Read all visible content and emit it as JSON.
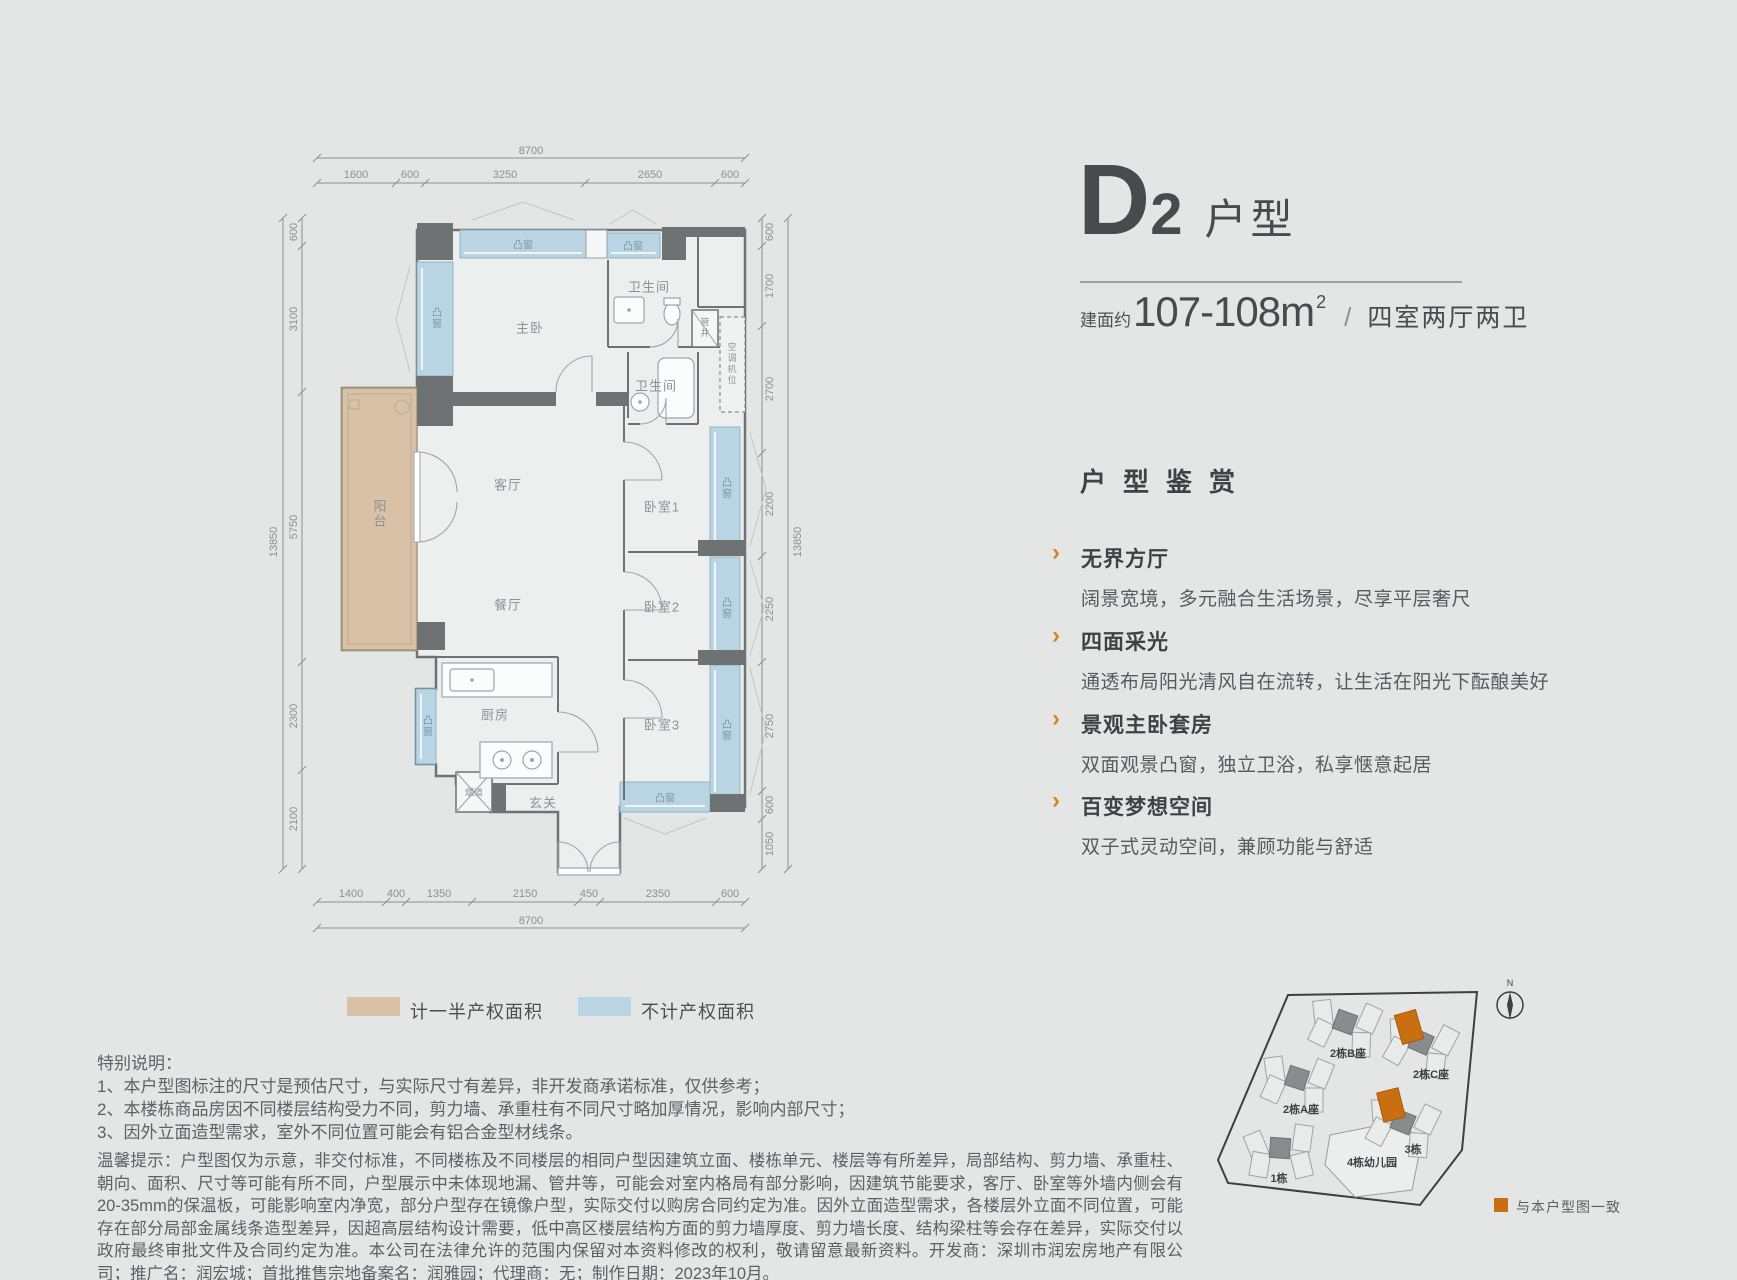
{
  "colors": {
    "background": "#e4e6e6",
    "accent_orange": "#d9831f",
    "highlight_orange": "#c96f12",
    "bay_blue": "#b9d4e2",
    "balcony_beige": "#d9c1a6",
    "wall_gray": "#6e7272",
    "dark_text": "#474b4b"
  },
  "header": {
    "type_letter": "D",
    "type_number": "2",
    "type_suffix": "户型",
    "area_prefix": "建面约",
    "area_value": "107-108m",
    "area_sup": "2",
    "area_slash": "/",
    "rooms_desc": "四室两厅两卫"
  },
  "appreciation": {
    "heading": "户型鉴赏",
    "items": [
      {
        "title": "无界方厅",
        "desc": "阔景宽境，多元融合生活场景，尽享平层奢尺"
      },
      {
        "title": "四面采光",
        "desc": "通透布局阳光清风自在流转，让生活在阳光下酝酿美好"
      },
      {
        "title": "景观主卧套房",
        "desc": "双面观景凸窗，独立卫浴，私享惬意起居"
      },
      {
        "title": "百变梦想空间",
        "desc": "双子式灵动空间，兼顾功能与舒适"
      }
    ]
  },
  "plan": {
    "rooms": {
      "master": "主卧",
      "bath": "卫生间",
      "living": "客厅",
      "dining": "餐厅",
      "kitchen": "厨房",
      "foyer": "玄关",
      "flue": "烟道",
      "shaft": "管井",
      "ac": "空调机位",
      "balcony": "阳台",
      "bed1": "卧室1",
      "bed2": "卧室2",
      "bed3": "卧室3",
      "bay": "凸窗"
    },
    "dims": {
      "top_total": "8700",
      "top": [
        "1600",
        "600",
        "3250",
        "2650",
        "600"
      ],
      "bottom": [
        "1400",
        "400",
        "1350",
        "2150",
        "450",
        "2350",
        "600"
      ],
      "bottom_total": "8700",
      "left": [
        "600",
        "3100",
        "5750",
        "2300",
        "2100"
      ],
      "left_total": "13850",
      "right": [
        "600",
        "1700",
        "2700",
        "2200",
        "2250",
        "2750",
        "600",
        "1050"
      ],
      "right_total": "13850"
    }
  },
  "legend": {
    "half_property": "计一半产权面积",
    "no_property": "不计产权面积"
  },
  "special_notes": {
    "title": "特别说明：",
    "item1": "1、本户型图标注的尺寸是预估尺寸，与实际尺寸有差异，非开发商承诺标准，仅供参考；",
    "item2": "2、本楼栋商品房因不同楼层结构受力不同，剪力墙、承重柱有不同尺寸略加厚情况，影响内部尺寸；",
    "item3": "3、因外立面造型需求，室外不同位置可能会有铝合金型材线条。"
  },
  "tips": "温馨提示：户型图仅为示意，非交付标准，不同楼栋及不同楼层的相同户型因建筑立面、楼栋单元、楼层等有所差异，局部结构、剪力墙、承重柱、朝向、面积、尺寸等可能有所不同，户型展示中未体现地漏、管井等，可能会对室内格局有部分影响，因建筑节能要求，客厅、卧室等外墙内侧会有20-35mm的保温板，可能影响室内净宽，部分户型存在镜像户型，实际交付以购房合同约定为准。因外立面造型需求，各楼层外立面不同位置，可能存在部分局部金属线条造型差异，因超高层结构设计需要，低中高区楼层结构方面的剪力墙厚度、剪力墙长度、结构梁柱等会存在差异，实际交付以政府最终审批文件及合同约定为准。本公司在法律允许的范围内保留对本资料修改的权利，敬请留意最新资料。开发商：深圳市润宏房地产有限公司；推广名：润宏城；首批推售宗地备案名：润雅园；代理商：无；制作日期：2023年10月。",
  "sitemap": {
    "buildings": {
      "b2b": "2栋B座",
      "b2c": "2栋C座",
      "b2a": "2栋A座",
      "b3": "3栋",
      "b1": "1栋",
      "kindergarten": "4栋幼儿园"
    },
    "compass": "N",
    "match_legend": "与本户型图一致"
  }
}
